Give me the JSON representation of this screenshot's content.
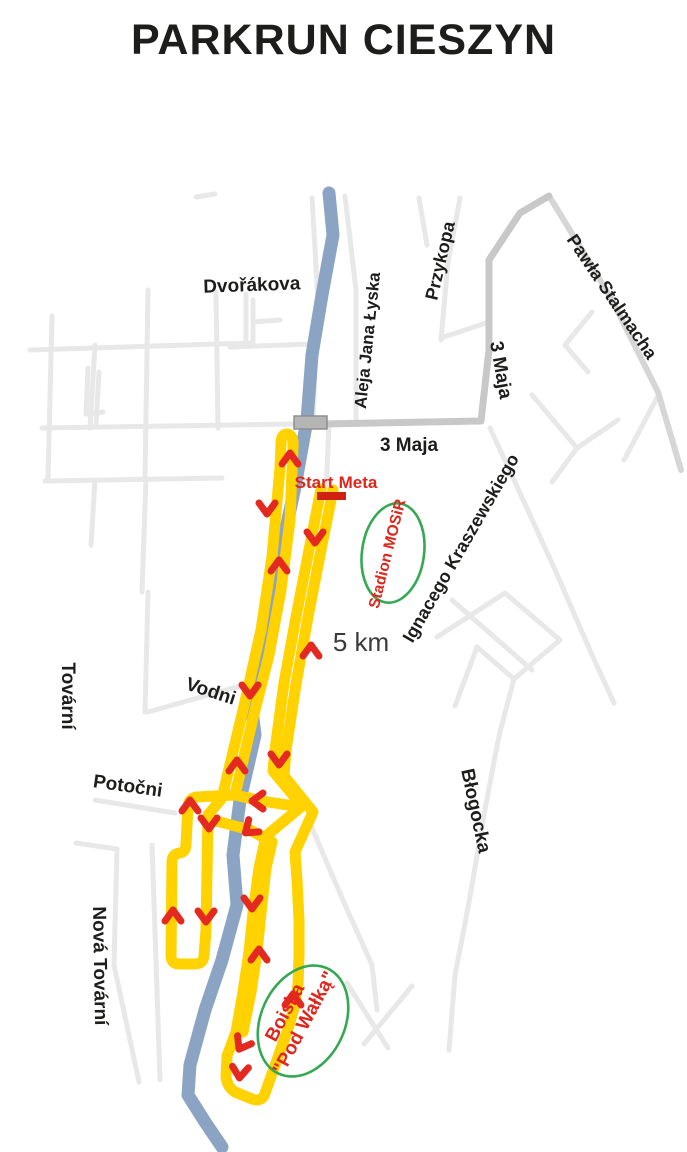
{
  "title": "PARKRUN CIESZYN",
  "map": {
    "distance_label": "5 km",
    "start_label": "Start",
    "finish_label": "Meta",
    "venues": {
      "stadium": "Stadion MOSiR",
      "fields_line1": "Boiska",
      "fields_line2": "\"Pod Wałką\""
    },
    "streets": {
      "dvorakova": "Dvořákova",
      "aleja_jana_lyska": "Aleja Jana Łyska",
      "przykopa": "Przykopa",
      "pawla_stalmacha": "Pawła Stalmacha",
      "maja3_upper": "3 Maja",
      "maja3_lower": "3 Maja",
      "ignacego_kraszewskiego": "Ignacego Kraszewskiego",
      "tovarni": "Tovární",
      "vodni": "Vodni",
      "potocni": "Potočni",
      "blogocka": "Błogocka",
      "nova_tovarni": "Nová Tovární"
    },
    "colors": {
      "route": "#ffd200",
      "river": "#8ca4c4",
      "arrows": "#e42a20",
      "start_bar": "#ce2013",
      "red_text": "#e0261c",
      "venue_outline": "#35a853",
      "roads_minor": "#e8e8e8",
      "roads_major": "#c8c8c8"
    }
  }
}
